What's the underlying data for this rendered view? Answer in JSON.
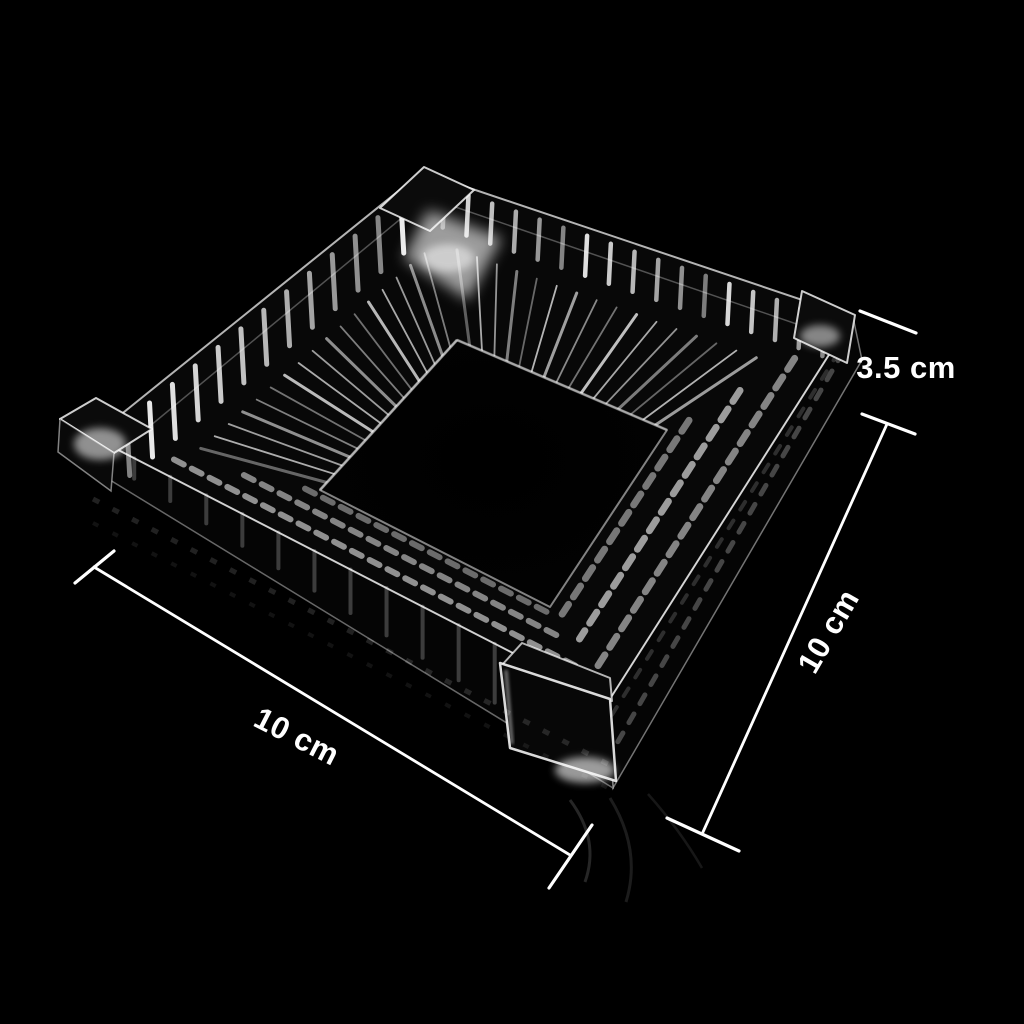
{
  "annotations": {
    "height": {
      "label": "3.5 cm"
    },
    "side": {
      "label": "10 cm"
    },
    "width": {
      "label": "10 cm"
    }
  },
  "colors": {
    "background": "#000000",
    "dimension_line": "#ffffff",
    "label_text": "#ffffff",
    "glass_highlight": "#ffffff",
    "well_shadow": "#000000"
  }
}
